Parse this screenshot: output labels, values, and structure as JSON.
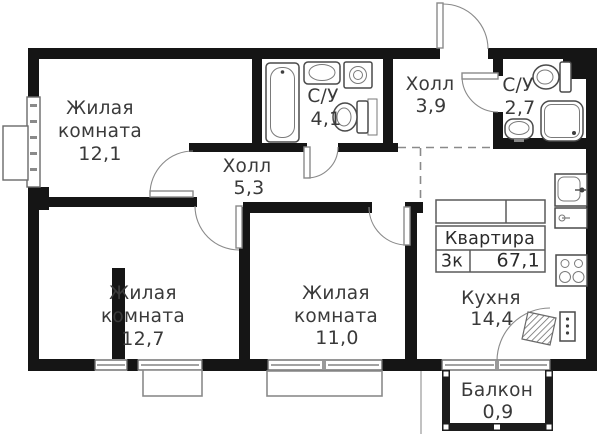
{
  "plan": {
    "rooms": [
      {
        "id": "living-1",
        "lines": [
          "Жилая",
          "комната"
        ],
        "area": "12,1"
      },
      {
        "id": "bathroom-1",
        "lines": [
          "С/У"
        ],
        "area": "4,1"
      },
      {
        "id": "hall-entry",
        "lines": [
          "Холл"
        ],
        "area": "3,9"
      },
      {
        "id": "bathroom-2",
        "lines": [
          "С/У"
        ],
        "area": "2,7"
      },
      {
        "id": "hall-inner",
        "lines": [
          "Холл"
        ],
        "area": "5,3"
      },
      {
        "id": "living-2",
        "lines": [
          "Жилая",
          "комната"
        ],
        "area": "12,7"
      },
      {
        "id": "living-3",
        "lines": [
          "Жилая",
          "комната"
        ],
        "area": "11,0"
      },
      {
        "id": "kitchen",
        "lines": [
          "Кухня"
        ],
        "area": "14,4"
      },
      {
        "id": "balcony",
        "lines": [
          "Балкон"
        ],
        "area": "0,9"
      }
    ],
    "info_table": {
      "title": "Квартира",
      "rooms_count": "3к",
      "total_area": "67,1"
    },
    "icons": {
      "bathtub": "bathtub-icon",
      "sink": "sink-icon",
      "washing_machine": "washing-machine-icon",
      "toilet": "toilet-icon",
      "shower": "shower-icon",
      "kitchen_sink": "kitchen-sink-icon",
      "cooktop": "cooktop-icon",
      "fridge": "fridge-icon",
      "vent_shaft": "vent-shaft"
    },
    "colors": {
      "wall": "#151515",
      "line": "#4a4a4a",
      "text": "#3a3a3a",
      "dash": "#8a8a8a",
      "background": "#ffffff"
    }
  }
}
